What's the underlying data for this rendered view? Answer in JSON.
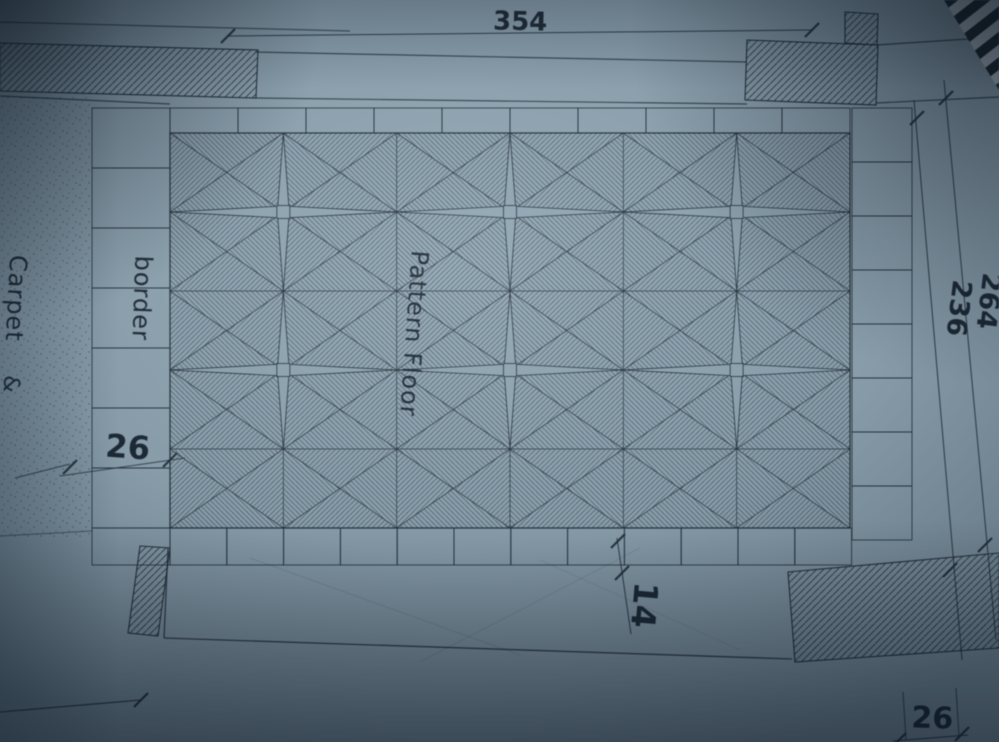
{
  "plan": {
    "area_labels": {
      "pattern_floor": "Pattern Floor",
      "border": "border",
      "carpet": "Carpet",
      "carpet_more": "&"
    },
    "dimensions": {
      "top_width": "354",
      "right_outer": "264",
      "right_inner": "236",
      "border_width": "26",
      "tile_width": "14",
      "corner_width": "26"
    },
    "colors": {
      "paper": "#93a7b4",
      "ink": "#243039",
      "stripe_dark": "#11161b",
      "stripe_light": "#c9d4da"
    }
  }
}
